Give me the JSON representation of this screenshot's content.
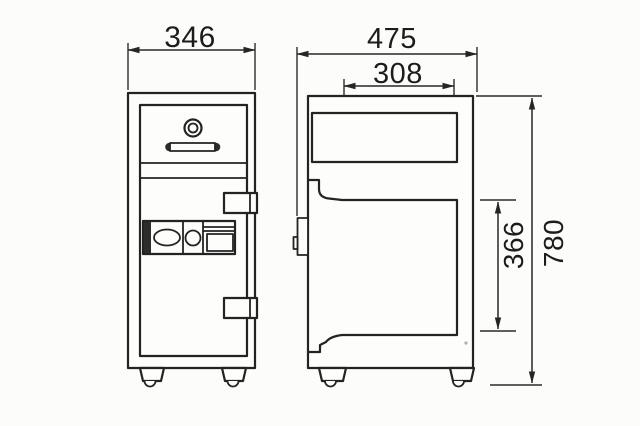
{
  "drawing": {
    "type": "technical-dimension-diagram",
    "colors": {
      "background": "#fcfcfa",
      "ink": "#232323",
      "hatch_strip_fill": "#2e2c2a"
    },
    "dimensions": {
      "front_width": {
        "value": "346"
      },
      "side_depth": {
        "value": "475"
      },
      "inner_depth": {
        "value": "308"
      },
      "inner_height": {
        "value": "366"
      },
      "overall_height": {
        "value": "780"
      }
    }
  }
}
